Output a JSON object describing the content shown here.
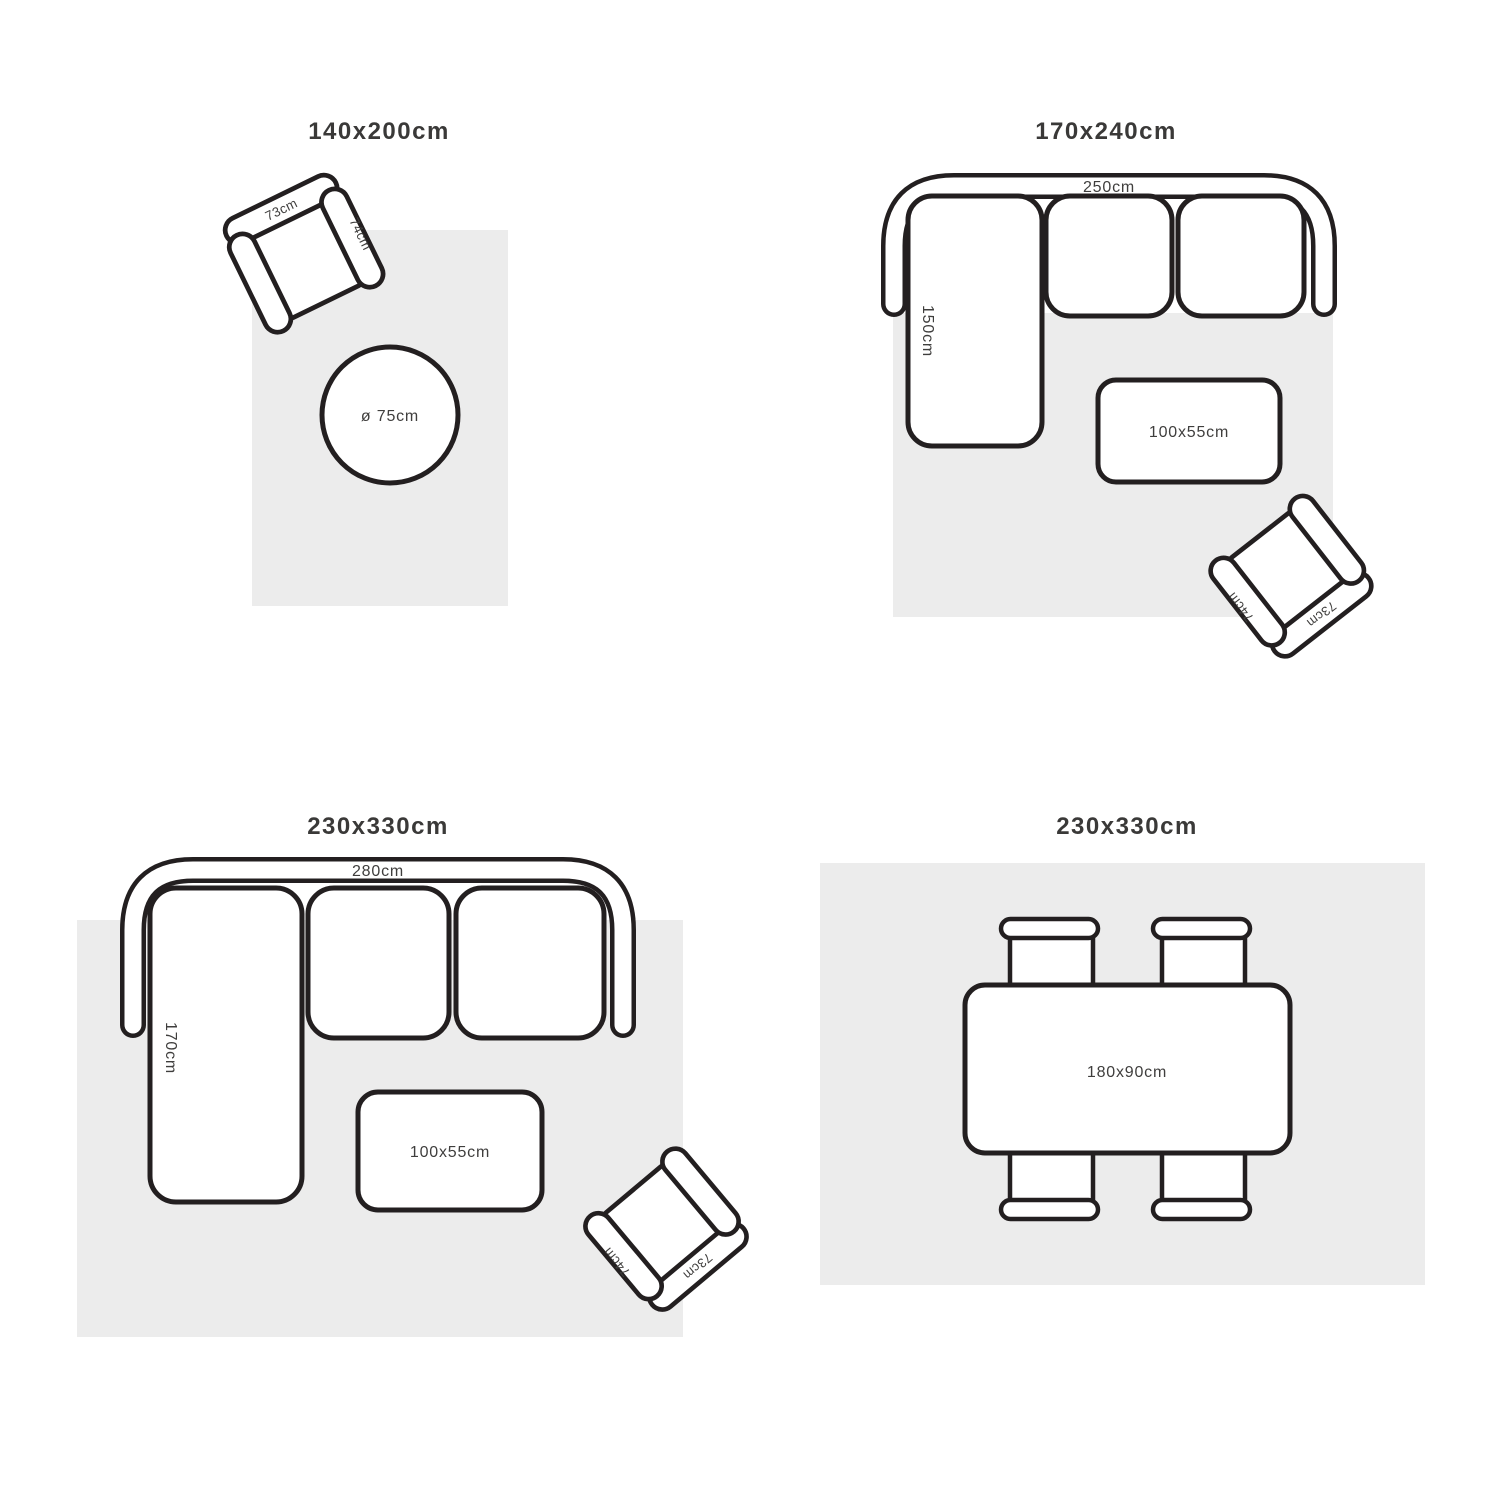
{
  "palette": {
    "background": "#ffffff",
    "outline": "#231f20",
    "rug_fill": "#ececec",
    "furniture_fill": "#ffffff",
    "title_text": "#3a3938",
    "label_text": "#3f3e3d"
  },
  "quadrants": {
    "q1": {
      "title": "140x200cm",
      "round_table_label": "ø 75cm"
    },
    "q2": {
      "title": "170x240cm",
      "sofa_length_label": "250cm",
      "chaise_depth_label": "150cm",
      "coffee_table_label": "100x55cm"
    },
    "q3": {
      "title": "230x330cm",
      "sofa_length_label": "280cm",
      "chaise_depth_label": "170cm",
      "coffee_table_label": "100x55cm"
    },
    "q4": {
      "title": "230x330cm",
      "dining_table_label": "180x90cm"
    }
  },
  "armchair": {
    "back_label": "73cm",
    "arm_label": "74cm"
  }
}
